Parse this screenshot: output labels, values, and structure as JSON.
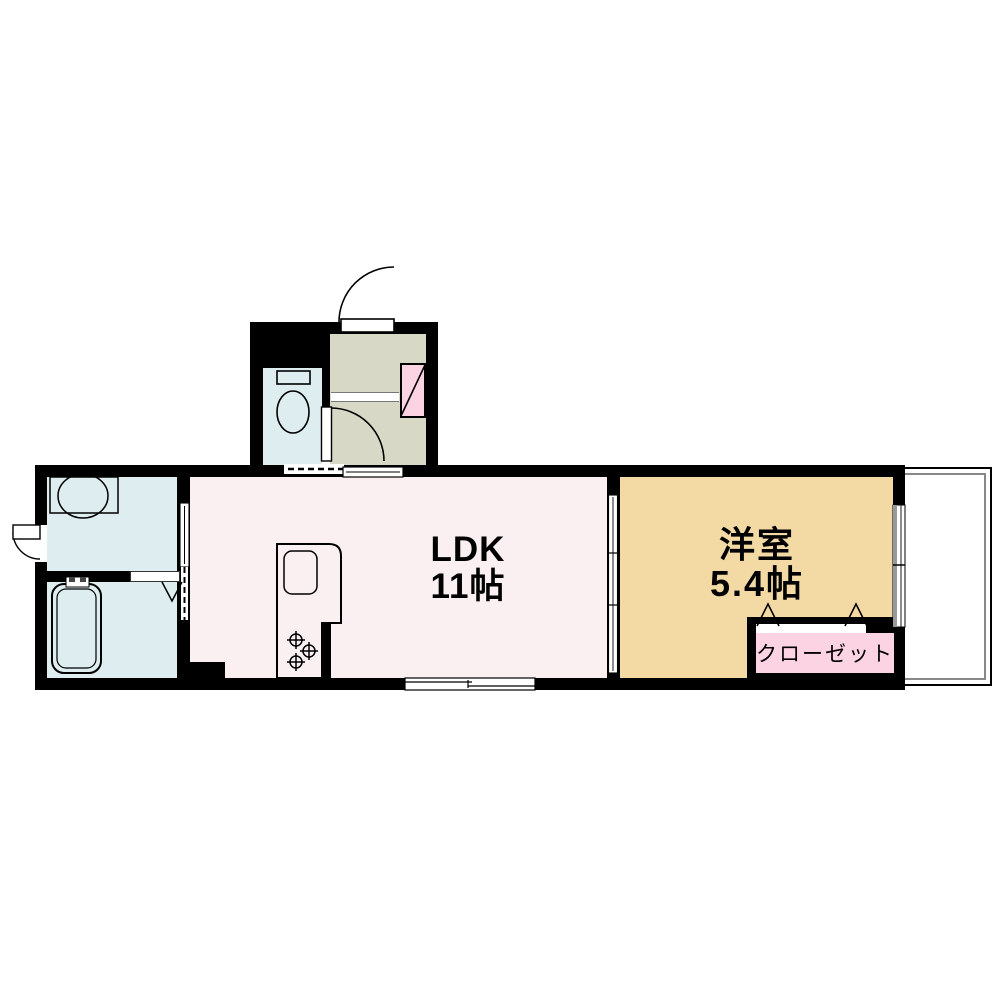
{
  "floorplan": {
    "rooms": {
      "ldk": {
        "name": "LDK",
        "area": "11帖",
        "floor_color": "#faf0f1"
      },
      "western_room": {
        "name": "洋室",
        "area": "5.4帖",
        "floor_color": "#f3d9a4"
      },
      "closet": {
        "label": "クローゼット",
        "fill_color": "#fbd3e3"
      },
      "entrance_hall": {
        "floor_color": "#d8d8c6"
      },
      "toilet_room": {
        "floor_color": "#ddedf0"
      },
      "washroom": {
        "floor_color": "#ddedf0"
      },
      "bathroom": {
        "floor_color": "#ddedf0"
      },
      "balcony": {
        "railing_color": "#888888"
      },
      "shoe_cabinet": {
        "fill_color": "#fbd3e3"
      }
    },
    "colors": {
      "wall": "#000000",
      "fixture_outline": "#000000",
      "background": "#ffffff"
    }
  }
}
